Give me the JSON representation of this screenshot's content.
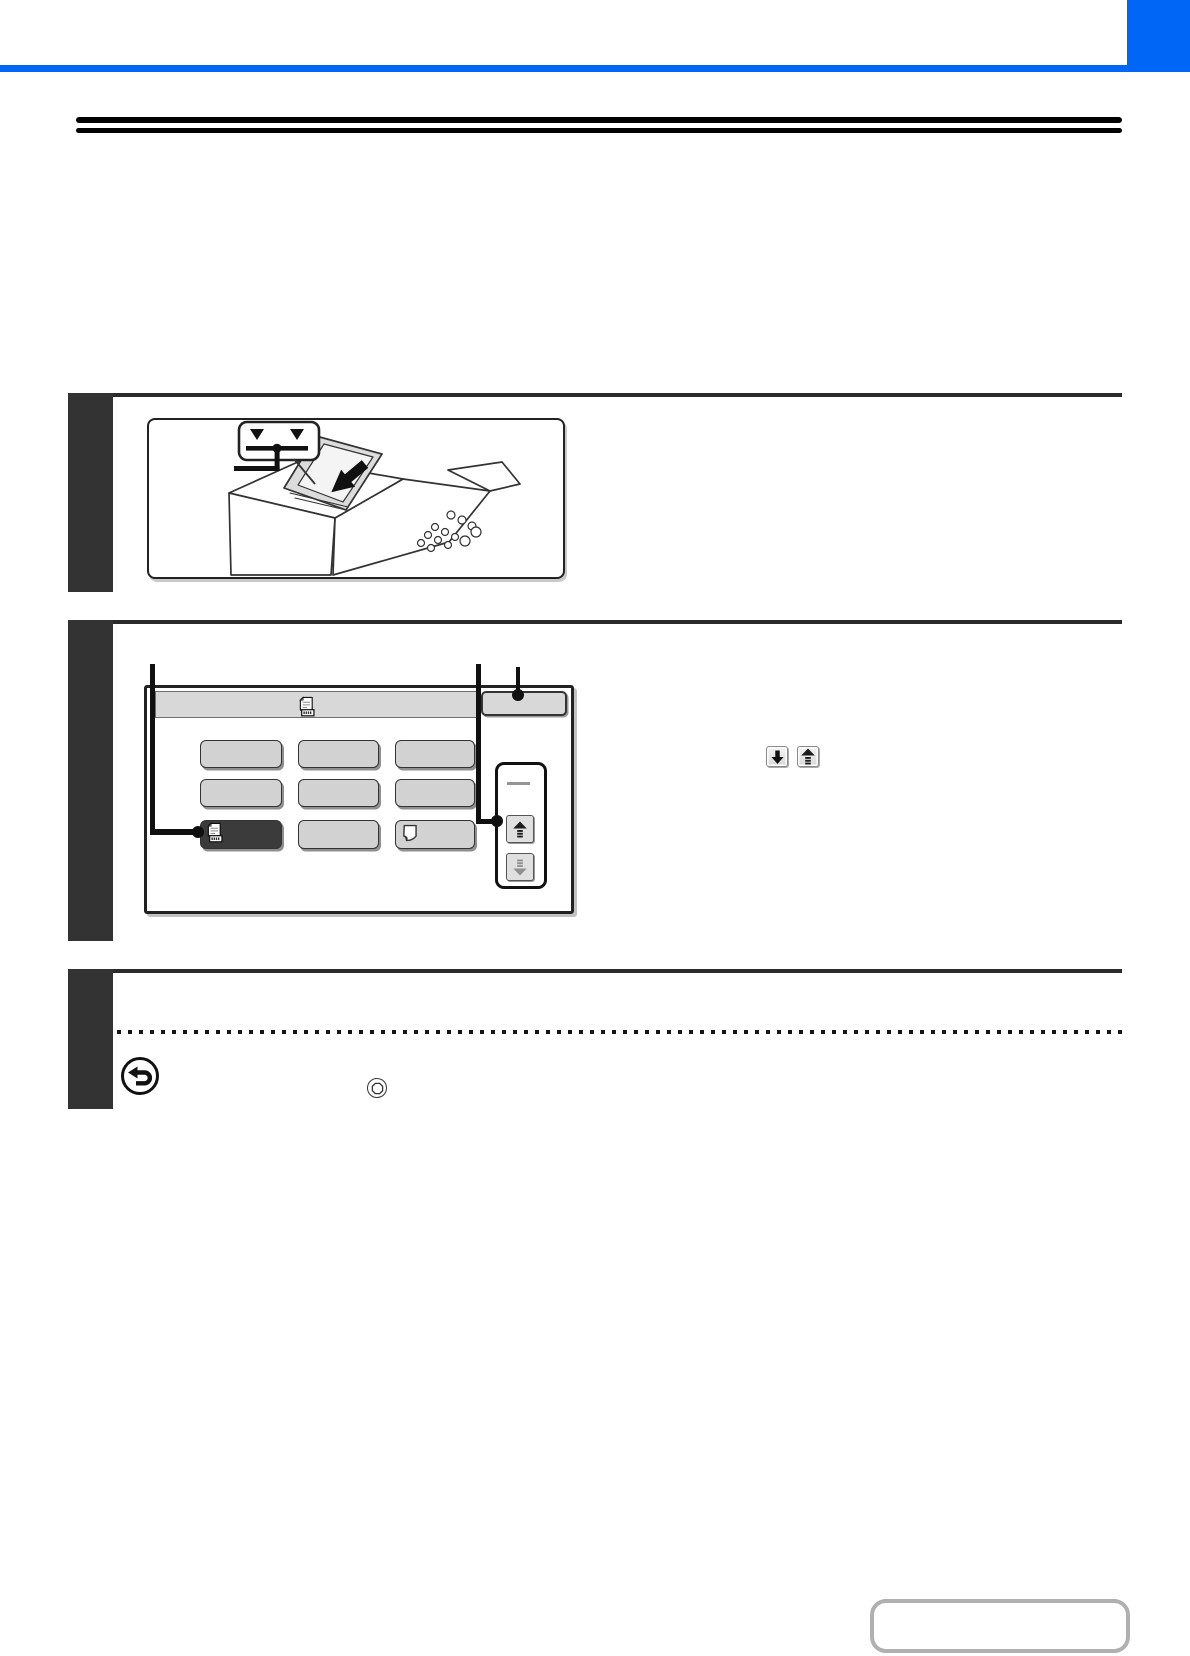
{
  "document": {
    "type": "instruction-manual-page",
    "visible_text": ""
  },
  "colors": {
    "accent_blue": "#0066F5",
    "rule_black": "#000000",
    "step_block": "#333333",
    "separator_line": "#2B2B2B",
    "screen_key_fill": "#D2D2D2",
    "screen_key_selected": "#3B3B3B",
    "nav_box_border": "#B0B0B0"
  },
  "header": {
    "top_bar": true,
    "corner_block": true,
    "title_text": ""
  },
  "title": {
    "rule_style": "double",
    "text": ""
  },
  "steps": [
    {
      "number": "",
      "figure": "document-feeder-loading-illustration",
      "callout": {
        "indicator_triangles": 2,
        "indicator_line": true
      }
    },
    {
      "number": "",
      "figure": "touch-panel-screen",
      "screen": {
        "header_icon": "document-number-icon",
        "header_button_label": "",
        "keys": [
          {
            "row": 1,
            "col": 1,
            "label": "",
            "variant": "plain"
          },
          {
            "row": 1,
            "col": 2,
            "label": "",
            "variant": "plain"
          },
          {
            "row": 1,
            "col": 3,
            "label": "",
            "variant": "plain"
          },
          {
            "row": 2,
            "col": 1,
            "label": "",
            "variant": "plain"
          },
          {
            "row": 2,
            "col": 2,
            "label": "",
            "variant": "plain"
          },
          {
            "row": 3,
            "col": 1,
            "label": "",
            "variant": "selected",
            "icon": "document-number-icon"
          },
          {
            "row": 3,
            "col": 2,
            "label": "",
            "variant": "plain"
          },
          {
            "row": 3,
            "col": 3,
            "label": "",
            "variant": "plain",
            "icon": "page-curl-icon"
          },
          {
            "row": 2,
            "col": 3,
            "label": "",
            "variant": "plain"
          }
        ],
        "scroll_panel": {
          "buttons": [
            {
              "icon": "up-arrow"
            },
            {
              "icon": "down-arrow"
            }
          ]
        },
        "callouts": [
          "selected-key",
          "scroll-up-key",
          "header-button"
        ]
      },
      "inline_keys": [
        {
          "icon": "down-arrow-key"
        },
        {
          "icon": "up-arrow-key"
        }
      ]
    },
    {
      "number": "",
      "divider": "dotted",
      "icons": [
        {
          "name": "return-arrow-icon"
        },
        {
          "name": "stop-key-icon"
        }
      ]
    }
  ],
  "footer": {
    "nav_button_label": ""
  }
}
